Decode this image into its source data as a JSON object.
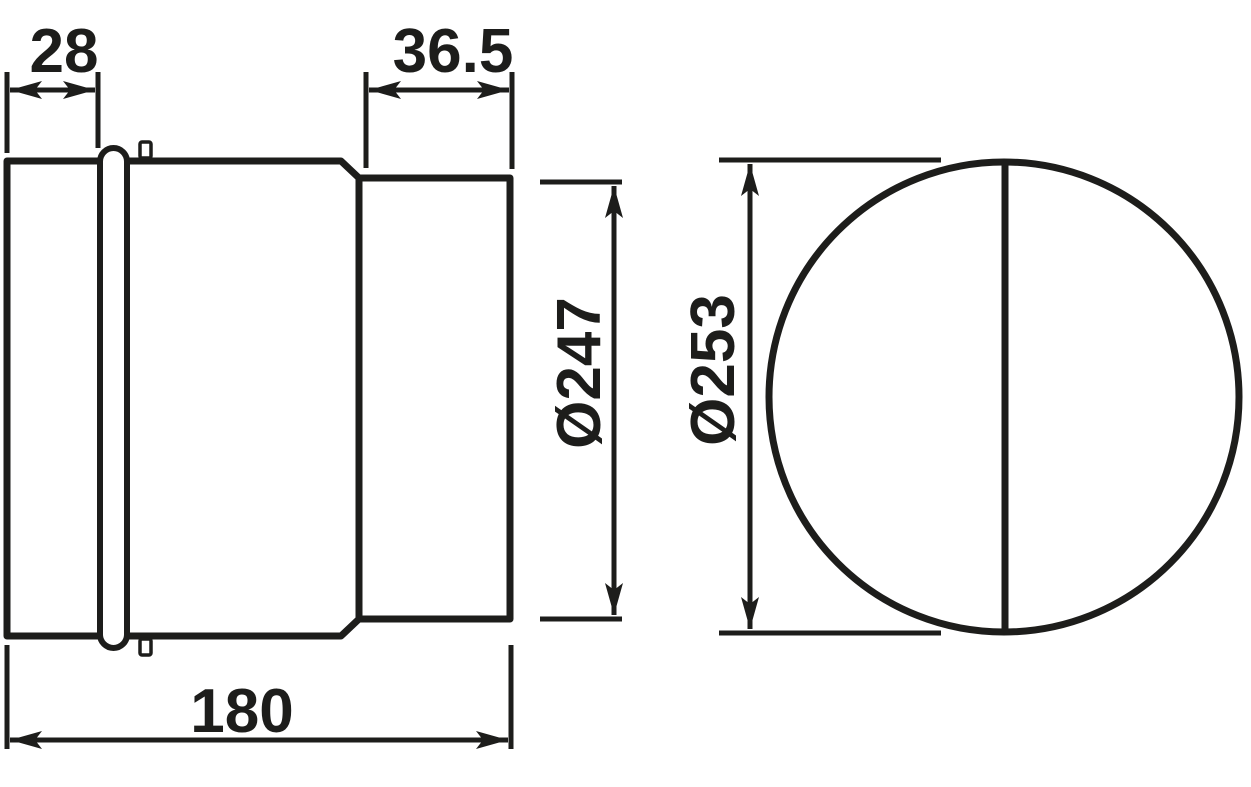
{
  "drawing": {
    "kind": "technical-dimension-drawing",
    "views": {
      "side_view": "cylindrical body with crimped lip, seam bead and reduced spigot",
      "front_view": "circle with vertical damper flap line"
    },
    "dimensions": {
      "lip_length": "28",
      "spigot_length": "36.5",
      "spigot_diameter": "Ø247",
      "body_diameter": "Ø253",
      "total_length": "180"
    },
    "colors": {
      "line": "#1d1d1b",
      "background": "#ffffff"
    }
  }
}
